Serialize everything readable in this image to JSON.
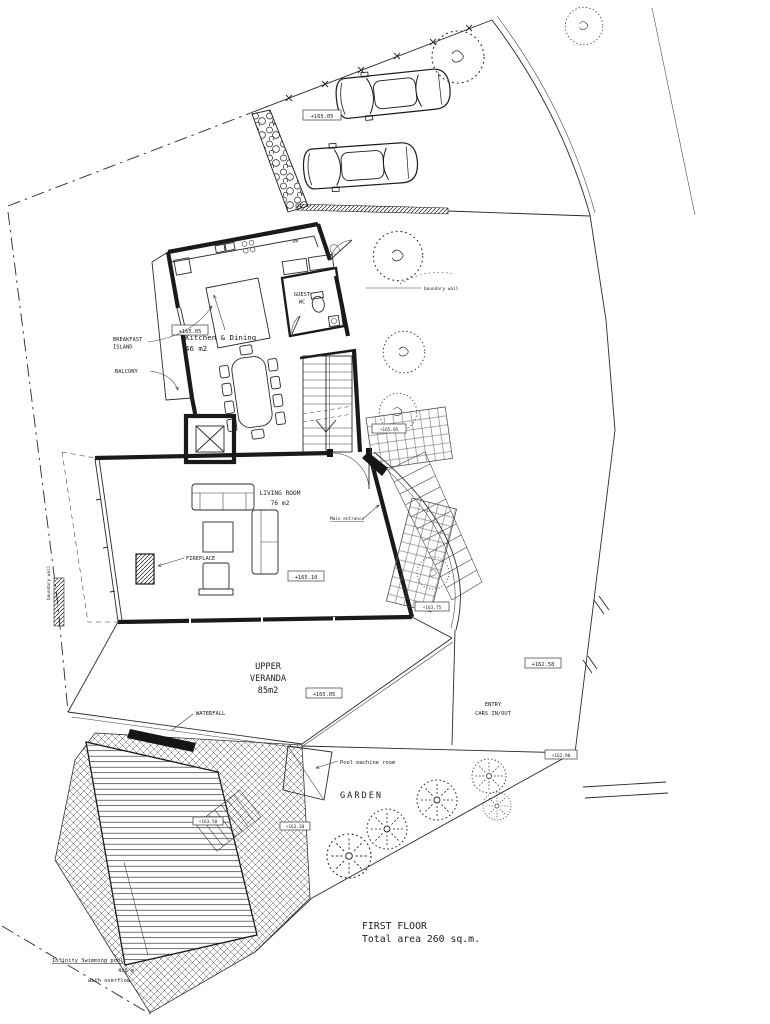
{
  "plan": {
    "title_line1": "FIRST FLOOR",
    "title_line2": "Total area 260 sq.m.",
    "kitchen_name": "Kitchen & Dining",
    "kitchen_area": "46 m2",
    "guest_wc_line1": "GUEST",
    "guest_wc_line2": "WC",
    "living_name": "LIVING ROOM",
    "living_area": "76 m2",
    "veranda_line1": "UPPER",
    "veranda_line2": "VERANDA",
    "veranda_line3": "85m2",
    "garden": "GARDEN",
    "breakfast_line1": "BREAKFAST",
    "breakfast_line2": "ISLAND",
    "balcony": "BALCONY",
    "fireplace": "FIREPLACE",
    "main_entrance": "Main entrance",
    "waterfall": "WATERFALL",
    "pool_machine_room": "Pool machine room",
    "entry_line1": "ENTRY",
    "entry_line2": "CARS IN/OUT",
    "pool_line1": "Infinity Swimming pool",
    "pool_line2": "4x8 m",
    "pool_line3": "with overflow",
    "dishwasher": "DW",
    "boundary_wall": "boundary wall"
  },
  "elevations": {
    "parking": "+165.05",
    "balcony": "+165.05",
    "terrace": "+165.05",
    "living_room": "+165.10",
    "veranda": "+165.05",
    "landing": "+163.75",
    "driveway": "+162.58",
    "pool_deck": "+163.50",
    "pool_steps": "+163.30",
    "site_corner": "+162.90"
  },
  "colors": {
    "ink": "#1a1a1a",
    "paper": "#ffffff"
  }
}
